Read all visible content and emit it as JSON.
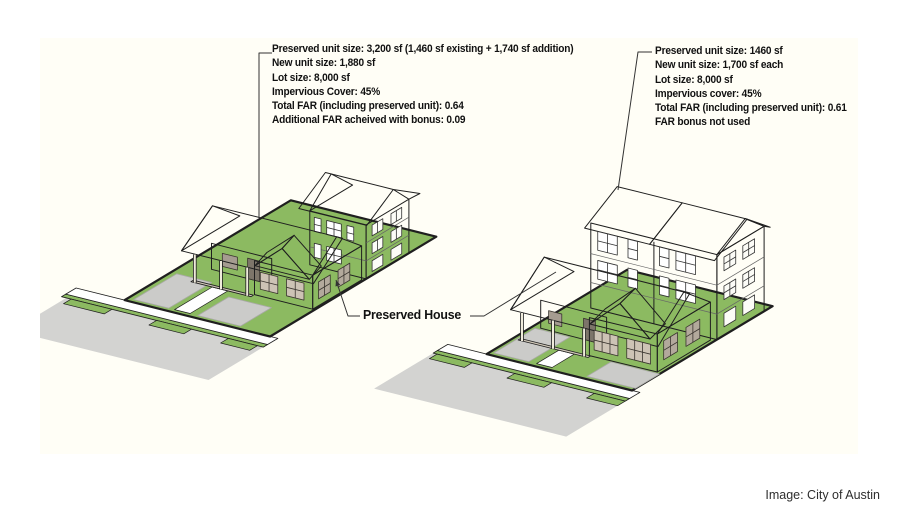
{
  "canvas": {
    "credit": "Image: City of Austin"
  },
  "annotations": {
    "left": {
      "lines": [
        "Preserved unit size: 3,200 sf (1,460 sf existing + 1,740 sf addition)",
        "New unit size: 1,880 sf",
        "Lot size: 8,000 sf",
        "Impervious Cover: 45%",
        "Total FAR (including preserved unit): 0.64",
        "Additional FAR acheived with bonus: 0.09"
      ]
    },
    "right": {
      "lines": [
        "Preserved unit size: 1460 sf",
        "New unit size: 1,700 sf each",
        "Lot size: 8,000 sf",
        "Impervious cover: 45%",
        "Total FAR (including preserved unit): 0.61",
        "FAR bonus not used"
      ]
    },
    "preserved_house_label": "Preserved House"
  },
  "colors": {
    "panel_bg": "#FFFEF6",
    "lawn": "#8CBA61",
    "street": "#D3D3D1",
    "pad": "#CBCBC9",
    "apron": "#E6E6E2",
    "sidewalk": "#FFFFFF",
    "roof_cream": "#F4F0E0",
    "roof_cream_dark": "#EAE5D1",
    "wall_tan": "#B9AEA1",
    "wall_tan_dark": "#A89D90",
    "gable_tan": "#C6BCAE",
    "porch_shadow": "#857C71",
    "building_white": "#FFFFFF",
    "outline": "#1F1F1F"
  }
}
